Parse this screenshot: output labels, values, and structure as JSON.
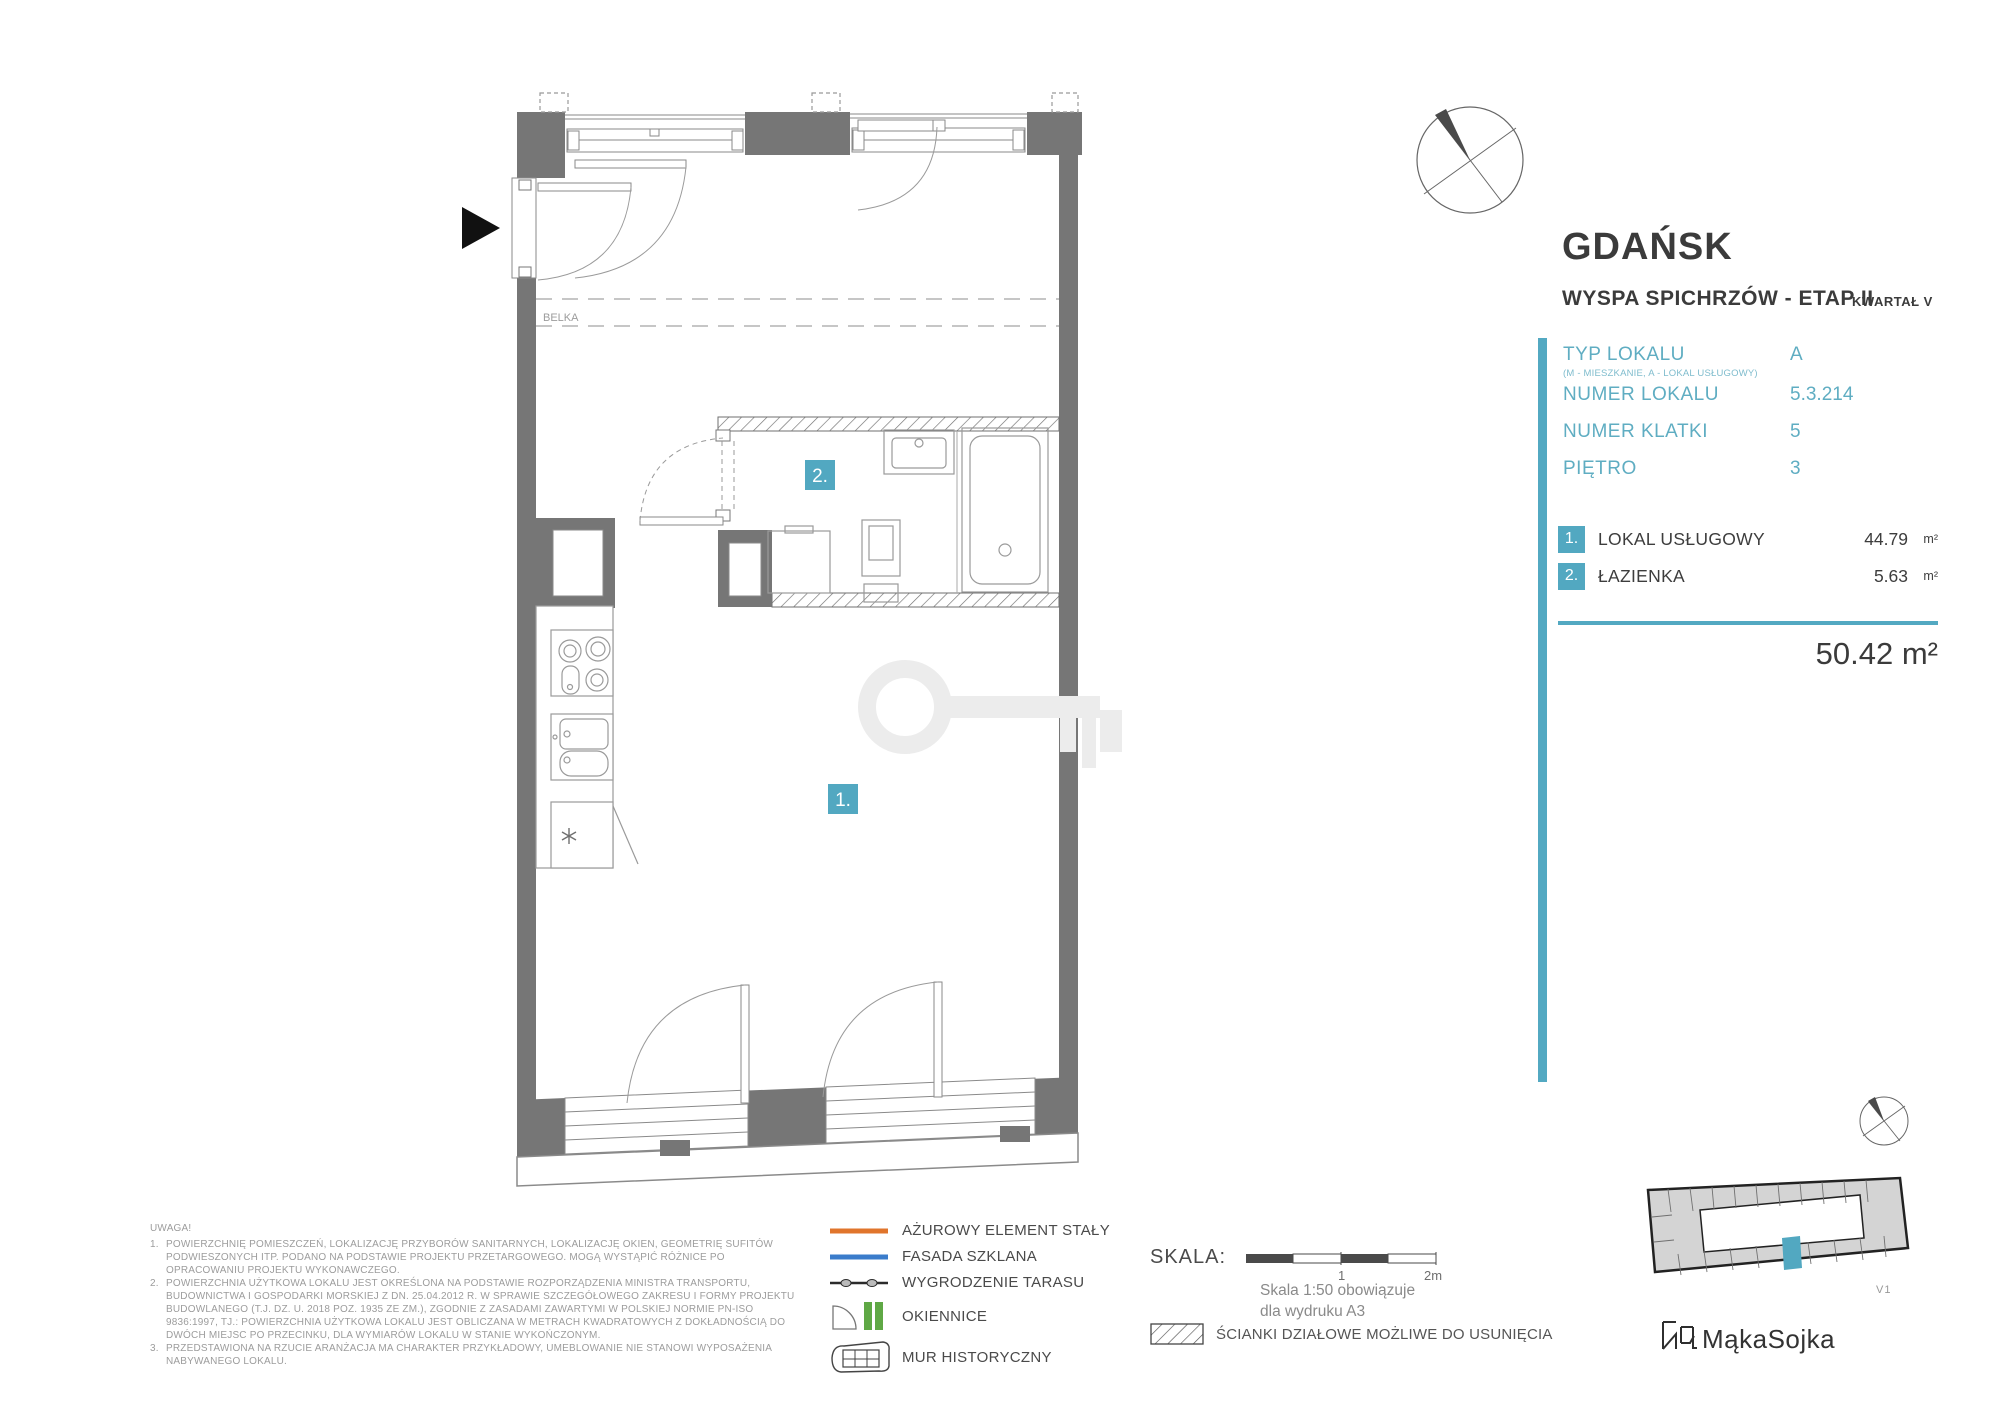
{
  "header": {
    "city": "GDAŃSK",
    "subtitle": "WYSPA SPICHRZÓW - ETAP II",
    "quarter": "KWARTAŁ V"
  },
  "unit_info": {
    "rows": [
      {
        "label": "TYP LOKALU",
        "sublabel": "(M - MIESZKANIE, A - LOKAL USŁUGOWY)",
        "value": "A"
      },
      {
        "label": "NUMER LOKALU",
        "value": "5.3.214"
      },
      {
        "label": "NUMER KLATKI",
        "value": "5"
      },
      {
        "label": "PIĘTRO",
        "value": "3"
      }
    ]
  },
  "rooms": {
    "items": [
      {
        "num": "1.",
        "name": "LOKAL USŁUGOWY",
        "area": "44.79",
        "unit": "m²"
      },
      {
        "num": "2.",
        "name": "ŁAZIENKA",
        "area": "5.63",
        "unit": "m²"
      }
    ],
    "total_area": "50.42 m²"
  },
  "plan": {
    "badge_1": "1.",
    "badge_2": "2.",
    "beam_label": "BELKA"
  },
  "legend": {
    "items": [
      {
        "label": "AŻUROWY ELEMENT STAŁY"
      },
      {
        "label": "FASADA SZKLANA"
      },
      {
        "label": "WYGRODZENIE TARASU"
      },
      {
        "label": "OKIENNICE"
      },
      {
        "label": "MUR HISTORYCZNY"
      }
    ]
  },
  "scale": {
    "label": "SKALA:",
    "tick_mid": "1",
    "tick_end": "2m",
    "caption1": "Skala 1:50 obowiązuje",
    "caption2": "dla wydruku A3"
  },
  "partition_legend": "ŚCIANKI DZIAŁOWE MOŻLIWE DO USUNIĘCIA",
  "notes": {
    "title": "UWAGA!",
    "items": [
      "POWIERZCHNIĘ POMIESZCZEŃ, LOKALIZACJĘ PRZYBORÓW SANITARNYCH, LOKALIZACJĘ OKIEN, GEOMETRIĘ SUFITÓW PODWIESZONYCH ITP. PODANO NA PODSTAWIE PROJEKTU PRZETARGOWEGO. MOGĄ WYSTĄPIĆ RÓŻNICE PO OPRACOWANIU PROJEKTU WYKONAWCZEGO.",
      "POWIERZCHNIA UŻYTKOWA LOKALU JEST OKREŚLONA NA PODSTAWIE ROZPORZĄDZENIA MINISTRA TRANSPORTU, BUDOWNICTWA I GOSPODARKI MORSKIEJ Z DN. 25.04.2012 R. W SPRAWIE SZCZEGÓŁOWEGO ZAKRESU I FORMY PROJEKTU BUDOWLANEGO (T.J. DZ. U. 2018 POZ. 1935 ZE ZM.), ZGODNIE Z ZASADAMI ZAWARTYMI W POLSKIEJ NORMIE PN-ISO 9836:1997, TJ.: POWIERZCHNIA UŻYTKOWA LOKALU JEST OBLICZANA W METRACH KWADRATOWYCH Z DOKŁADNOŚCIĄ DO DWÓCH MIEJSC PO PRZECINKU, DLA WYMIARÓW LOKALU W STANIE WYKOŃCZONYM.",
      "PRZEDSTAWIONA NA RZUCIE ARANŻACJA MA CHARAKTER PRZYKŁADOWY, UMEBLOWANIE NIE STANOWI WYPOSAŻENIA NABYWANEGO LOKALU."
    ]
  },
  "sitemap": {
    "version": "V1"
  },
  "brand": {
    "name": "MąkaSojka"
  },
  "colors": {
    "accent_teal": "#52a8c1",
    "wall_gray": "#767676",
    "legend_orange": "#e0752c",
    "legend_blue": "#3a7ccb",
    "legend_green": "#5fa845"
  }
}
